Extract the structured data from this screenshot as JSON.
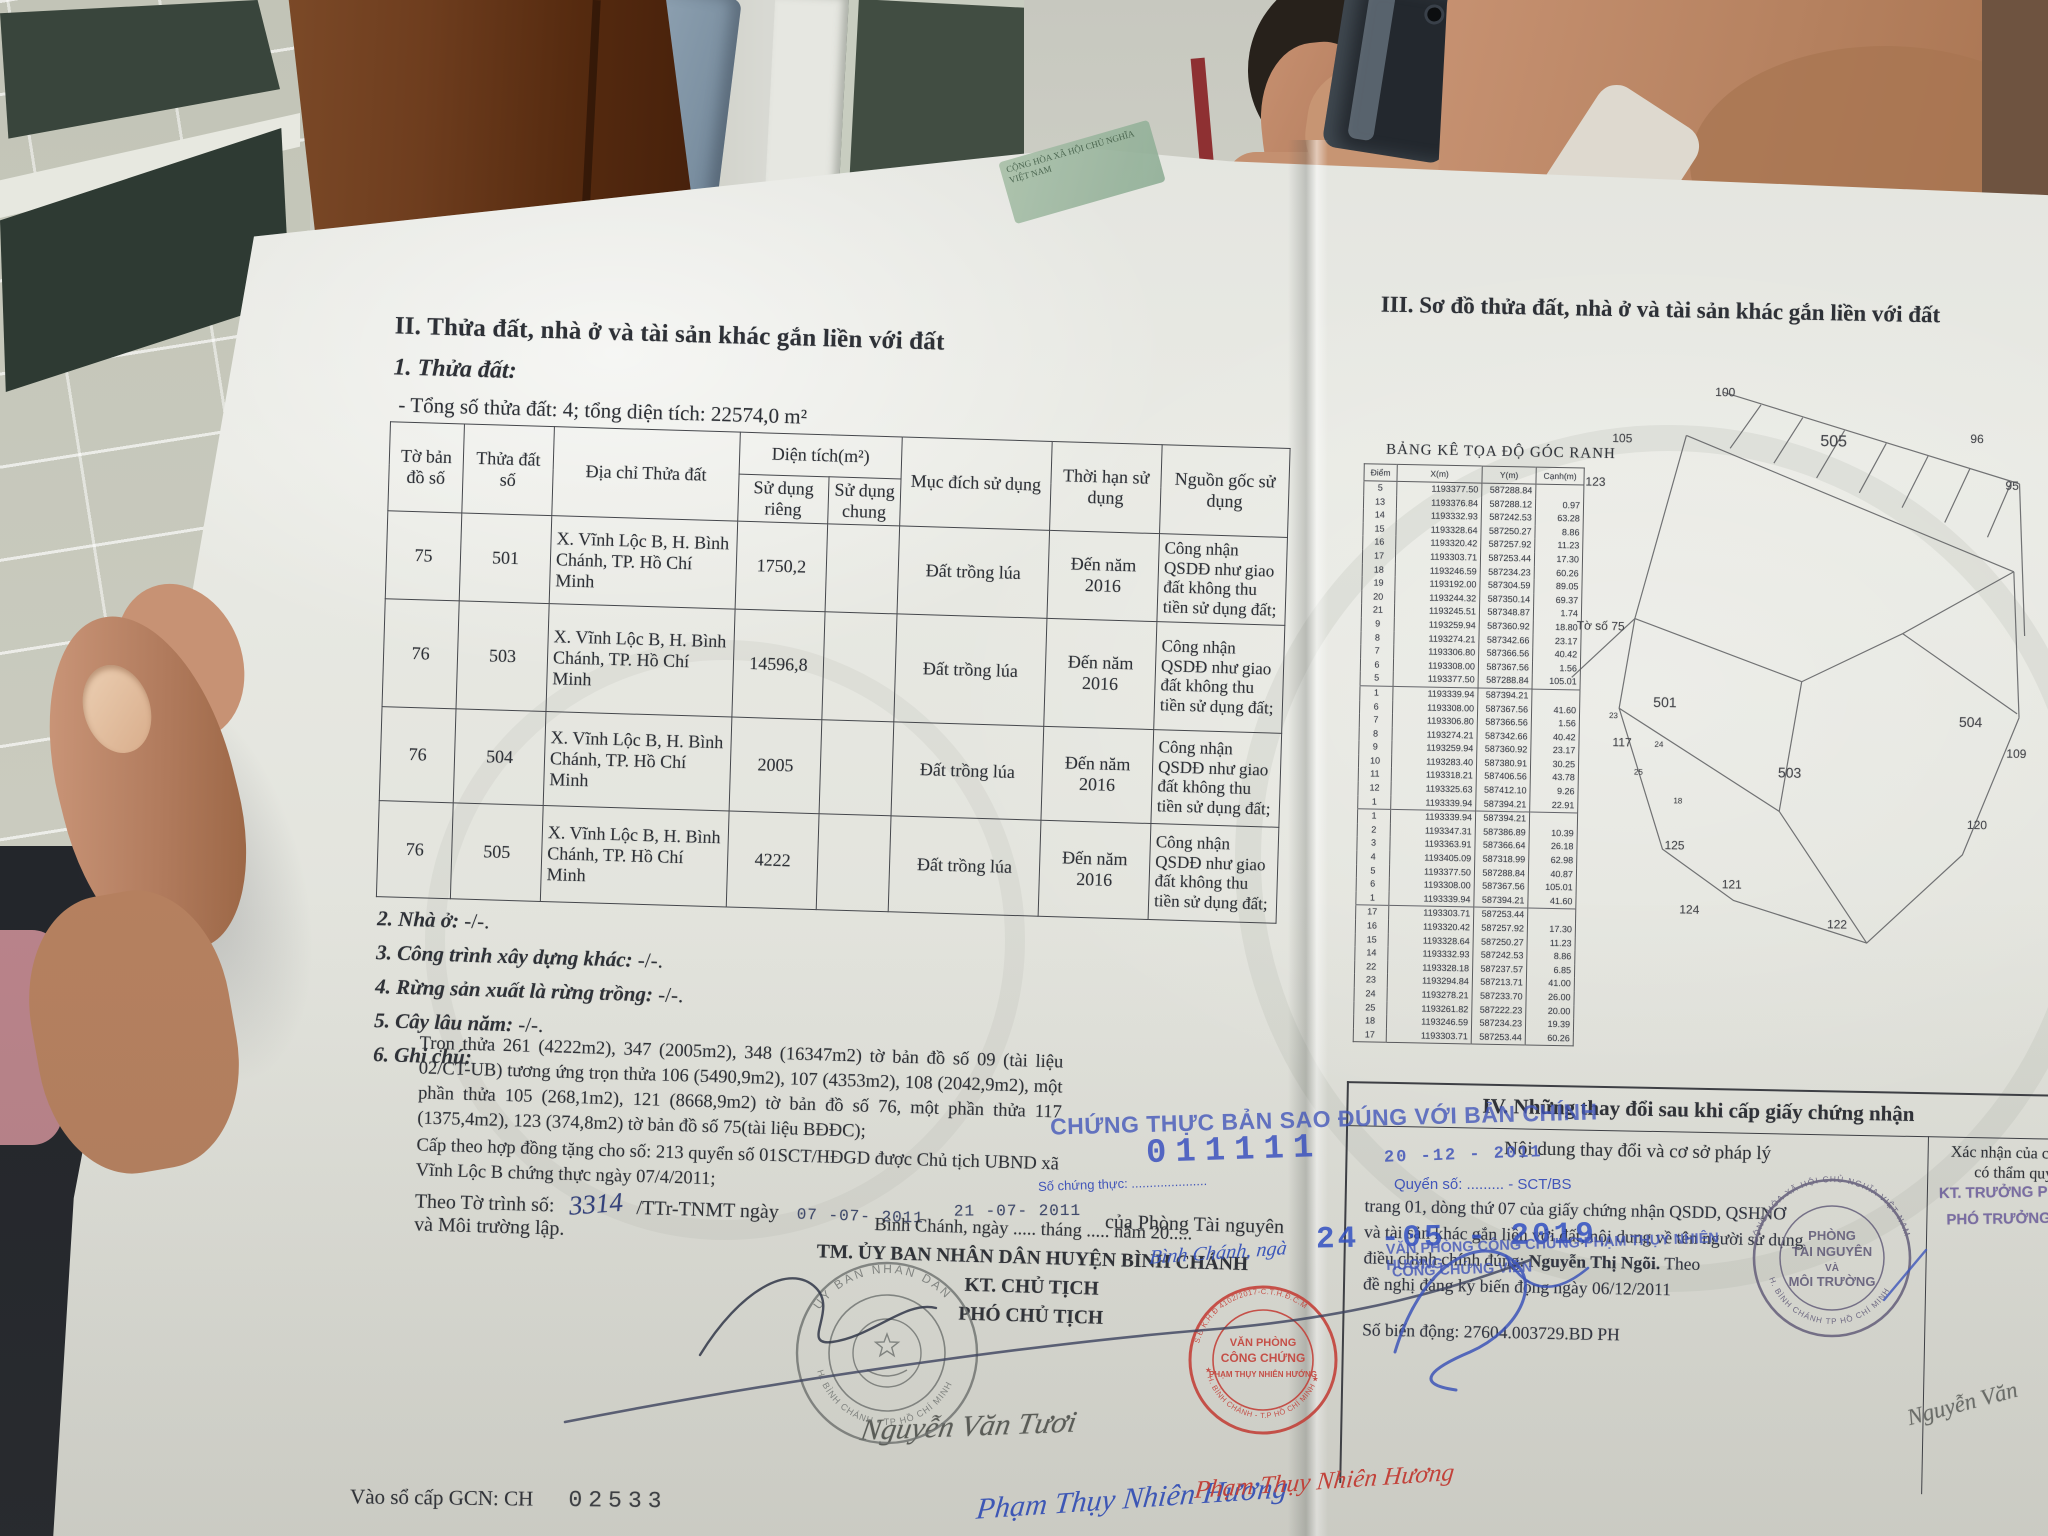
{
  "document": {
    "left_page": {
      "section_title": "II. Thửa đất, nhà ở và tài sản khác gắn liền với đất",
      "sub_title": "1. Thửa đất:",
      "total_line": "- Tổng số thửa đất: 4; tổng diện tích: 22574,0 m²",
      "table": {
        "headers": {
          "map_sheet": "Tờ bản đồ số",
          "parcel_no": "Thửa đất số",
          "address": "Địa chỉ Thửa đất",
          "area": "Diện tích(m²)",
          "private_use": "Sử dụng riêng",
          "common_use": "Sử dụng chung",
          "purpose": "Mục đích sử dụng",
          "term": "Thời hạn sử dụng",
          "origin": "Nguồn gốc sử dụng"
        },
        "rows": [
          {
            "to": "75",
            "thua": "501",
            "diachi": "X. Vĩnh Lộc B, H. Bình Chánh, TP. Hồ Chí Minh",
            "rieng": "1750,2",
            "chung": "",
            "mucdich": "Đất trồng lúa",
            "thoihan": "Đến năm 2016",
            "nguon": "Công nhận QSDĐ như giao đất không thu tiền sử dụng đất;"
          },
          {
            "to": "76",
            "thua": "503",
            "diachi": "X. Vĩnh Lộc B, H. Bình Chánh, TP. Hồ Chí Minh",
            "rieng": "14596,8",
            "chung": "",
            "mucdich": "Đất trồng lúa",
            "thoihan": "Đến năm 2016",
            "nguon": "Công nhận QSDĐ như giao đất không thu tiền sử dụng đất;"
          },
          {
            "to": "76",
            "thua": "504",
            "diachi": "X. Vĩnh Lộc B, H. Bình Chánh, TP. Hồ Chí Minh",
            "rieng": "2005",
            "chung": "",
            "mucdich": "Đất trồng lúa",
            "thoihan": "Đến năm 2016",
            "nguon": "Công nhận QSDĐ như giao đất không thu tiền sử dụng đất;"
          },
          {
            "to": "76",
            "thua": "505",
            "diachi": "X. Vĩnh Lộc B, H. Bình Chánh, TP. Hồ Chí Minh",
            "rieng": "4222",
            "chung": "",
            "mucdich": "Đất trồng lúa",
            "thoihan": "Đến năm 2016",
            "nguon": "Công nhận QSDĐ như giao đất không thu tiền sử dụng đất;"
          }
        ]
      },
      "items": [
        {
          "label": "2. Nhà ở:",
          "value": "-/-."
        },
        {
          "label": "3. Công trình xây dựng khác:",
          "value": "-/-."
        },
        {
          "label": "4. Rừng sản xuất là rừng trồng:",
          "value": "-/-."
        },
        {
          "label": "5. Cây lâu năm:",
          "value": "-/-."
        },
        {
          "label": "6. Ghi chú:",
          "value": ""
        }
      ],
      "notes": {
        "p1": "Trọn thửa 261 (4222m2), 347 (2005m2), 348 (16347m2) tờ bản đồ số 09 (tài liệu 02/CT-UB) tương ứng trọn thửa 106 (5490,9m2), 107 (4353m2), 108 (2042,9m2), một phần thửa 105 (268,1m2), 121 (8668,9m2)  tờ bản đồ số 76, một phần thửa 117 (1375,4m2), 123 (374,8m2) tờ bản đồ số 75(tài liệu BĐĐC);",
        "p2": "Cấp theo hợp đồng tặng cho số: 213 quyển số  01SCT/HĐGD được Chủ tịch UBND xã Vĩnh Lộc B  chứng thực ngày 07/4/2011;",
        "theo_label": "Theo Tờ trình số:",
        "theo_number": "3314",
        "theo_mid": "/TTr-TNMT ngày",
        "date_stamp_1": "07 -07- 2011",
        "date_stamp_2": "21 -07- 2011",
        "theo_tail": "của Phòng Tài nguyên",
        "last_line": "và Môi trường lập."
      },
      "sign_block": {
        "place_date_line": "Bình Chánh, ngày ..... tháng ..... năm 20.....",
        "line1": "TM. ỦY BAN NHÂN DÂN HUYỆN BÌNH CHÁNH",
        "line2": "KT. CHỦ TỊCH",
        "line3": "PHÓ CHỦ TỊCH",
        "signature": "Nguyễn Văn Tươi"
      },
      "stamp": {
        "arc_top": "ỦY BAN NHÂN DÂN",
        "arc_bottom": "H. BÌNH CHÁNH • TP HỒ CHÍ MINH"
      },
      "gcn_label": "Vào sổ cấp GCN: CH",
      "gcn_number": "02533"
    },
    "right_page": {
      "section_title": "III. Sơ đồ thửa đất, nhà ở và tài sản khác gắn liền với đất",
      "coord_table": {
        "title": "BẢNG KÊ TỌA ĐỘ GÓC RANH",
        "headers": [
          "Điểm",
          "X(m)",
          "Y(m)",
          "Cạnh(m)"
        ],
        "rows": [
          [
            "5",
            "1193377.50",
            "587288.84",
            ""
          ],
          [
            "13",
            "1193376.84",
            "587288.12",
            "0.97"
          ],
          [
            "14",
            "1193332.93",
            "587242.53",
            "63.28"
          ],
          [
            "15",
            "1193328.64",
            "587250.27",
            "8.86"
          ],
          [
            "16",
            "1193320.42",
            "587257.92",
            "11.23"
          ],
          [
            "17",
            "1193303.71",
            "587253.44",
            "17.30"
          ],
          [
            "18",
            "1193246.59",
            "587234.23",
            "60.26"
          ],
          [
            "19",
            "1193192.00",
            "587304.59",
            "89.05"
          ],
          [
            "20",
            "1193244.32",
            "587350.14",
            "69.37"
          ],
          [
            "21",
            "1193245.51",
            "587348.87",
            "1.74"
          ],
          [
            "9",
            "1193259.94",
            "587360.92",
            "18.80"
          ],
          [
            "8",
            "1193274.21",
            "587342.66",
            "23.17"
          ],
          [
            "7",
            "1193306.80",
            "587366.56",
            "40.42"
          ],
          [
            "6",
            "1193308.00",
            "587367.56",
            "1.56"
          ],
          [
            "5",
            "1193377.50",
            "587288.84",
            "105.01"
          ],
          [
            "1",
            "1193339.94",
            "587394.21",
            ""
          ],
          [
            "6",
            "1193308.00",
            "587367.56",
            "41.60"
          ],
          [
            "7",
            "1193306.80",
            "587366.56",
            "1.56"
          ],
          [
            "8",
            "1193274.21",
            "587342.66",
            "40.42"
          ],
          [
            "9",
            "1193259.94",
            "587360.92",
            "23.17"
          ],
          [
            "10",
            "1193283.40",
            "587380.91",
            "30.25"
          ],
          [
            "11",
            "1193318.21",
            "587406.56",
            "43.78"
          ],
          [
            "12",
            "1193325.63",
            "587412.10",
            "9.26"
          ],
          [
            "1",
            "1193339.94",
            "587394.21",
            "22.91"
          ],
          [
            "1",
            "1193339.94",
            "587394.21",
            ""
          ],
          [
            "2",
            "1193347.31",
            "587386.89",
            "10.39"
          ],
          [
            "3",
            "1193363.91",
            "587366.64",
            "26.18"
          ],
          [
            "4",
            "1193405.09",
            "587318.99",
            "62.98"
          ],
          [
            "5",
            "1193377.50",
            "587288.84",
            "40.87"
          ],
          [
            "6",
            "1193308.00",
            "587367.56",
            "105.01"
          ],
          [
            "1",
            "1193339.94",
            "587394.21",
            "41.60"
          ],
          [
            "17",
            "1193303.71",
            "587253.44",
            ""
          ],
          [
            "16",
            "1193320.42",
            "587257.92",
            "17.30"
          ],
          [
            "15",
            "1193328.64",
            "587250.27",
            "11.23"
          ],
          [
            "14",
            "1193332.93",
            "587242.53",
            "8.86"
          ],
          [
            "22",
            "1193328.18",
            "587237.57",
            "6.85"
          ],
          [
            "23",
            "1193294.84",
            "587213.71",
            "41.00"
          ],
          [
            "24",
            "1193278.21",
            "587233.70",
            "26.00"
          ],
          [
            "25",
            "1193261.82",
            "587222.23",
            "20.00"
          ],
          [
            "18",
            "1193246.59",
            "587234.23",
            "19.39"
          ],
          [
            "17",
            "1193303.71",
            "587253.44",
            "60.26"
          ]
        ]
      },
      "diagram": {
        "sheet_label": "Tờ số 75",
        "parcels": [
          "501",
          "503",
          "504",
          "505"
        ],
        "neighbors": [
          "100",
          "105",
          "96",
          "95",
          "109",
          "117",
          "120",
          "121",
          "122",
          "123",
          "124",
          "125"
        ],
        "vertices": [
          "23",
          "24",
          "25",
          "18"
        ]
      },
      "section4": {
        "title": "IV. Những thay đổi sau khi cấp giấy chứng nhận",
        "col_left": "Nội dung thay đổi và cơ sở pháp lý",
        "col_right_line1": "Xác nhận của cơ quan",
        "col_right_line2": "có thẩm quyền",
        "purple_line1": "KT. TRƯỞNG PHÒNG",
        "purple_line2": "PHÓ TRƯỞNG PHÒNG",
        "change_line1": "trang 01, dòng thứ 07 của giấy chứng nhận QSDD, QSHNƠ",
        "change_line2": "và tài sản khác gắn liền với đất, nội dung về tên người sử dụng",
        "change_line3a": "điều chỉnh chính đúng: ",
        "change_line3b": "Nguyễn Thị Ngõi.",
        "change_line3c": " Theo",
        "change_line4": "đề nghị đăng ký biến động ngày 06/12/2011",
        "change_line5": "Số biến động: 27604.003729.BD PH"
      },
      "round_stamp": {
        "l1": "PHÒNG",
        "l2": "TÀI NGUYÊN",
        "l3": "VÀ",
        "l4": "MÔI TRƯỜNG",
        "arc_top": "CỘNG HÒA XÃ HỘI CHỦ NGHĨA VIỆT NAM",
        "arc_bottom": "H. BÌNH CHÁNH TP HỒ CHÍ MINH"
      },
      "corner_signature": "Nguyễn Văn"
    },
    "notary_blue": {
      "certify": "CHỨNG THỰC BẢN SAO ĐÚNG VỚI BẢN CHÍNH",
      "so_ct_label": "Số chứng thực: .....................",
      "so_ct_value": "011111",
      "quyen_so": "Quyển số: ......... - SCT/BS",
      "date_2011": "20 -12 - 2011",
      "date_2019": "24 -05 - 2019",
      "place": "Bình Chánh, ngà",
      "office_line1": "VĂN PHÒNG CÔNG CHỨNG PHẠM THỤY NHIÊN HƯƠNG",
      "office_line2": "CÔNG CHỨNG VIÊN",
      "script_name": "Phạm Thụy Nhiên Hương"
    },
    "red_stamp": {
      "arc_top": "S.Đ.K.H.Đ 4102/2017-C.T.H.Đ.C.M",
      "l1": "VĂN PHÒNG",
      "l2": "CÔNG CHỨNG",
      "l3": "PHẠM THỤY NHIÊN HƯỚNG",
      "arc_bottom": "★ H. BÌNH CHÁNH - T.P HỒ CHÍ MINH ★",
      "script_name": "Phạm Thụy Nhiên Hương"
    },
    "fold_sliver": "CỘNG HÒA XÃ HỘI CHỦ NGHĨA VIỆT NAM"
  }
}
